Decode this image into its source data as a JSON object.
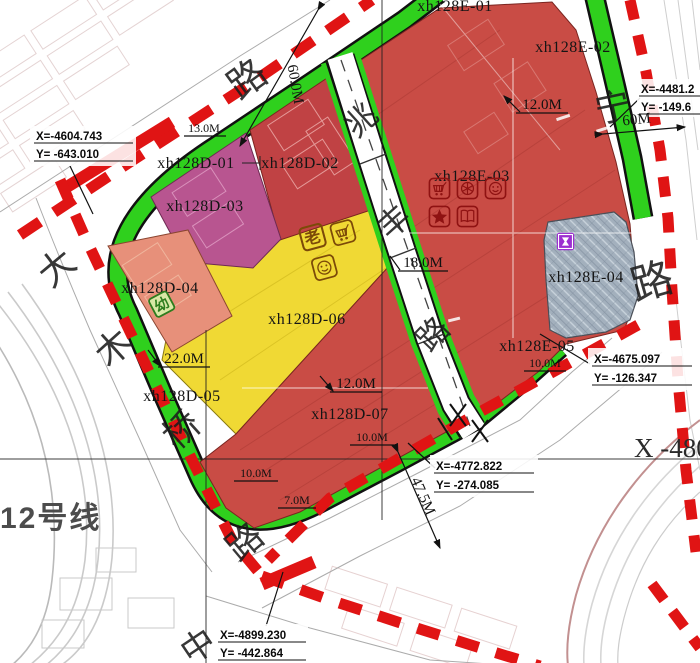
{
  "zones": {
    "d01": {
      "label": "xh128D-01"
    },
    "d02": {
      "label": "xh128D-02"
    },
    "d03": {
      "label": "xh128D-03"
    },
    "d04": {
      "label": "xh128D-04"
    },
    "d05": {
      "label": "xh128D-05"
    },
    "d06": {
      "label": "xh128D-06"
    },
    "d07": {
      "label": "xh128D-07"
    },
    "e01": {
      "label": "xh128E-01"
    },
    "e02": {
      "label": "xh128E-02"
    },
    "e03": {
      "label": "xh128E-03"
    },
    "e04": {
      "label": "xh128E-04"
    },
    "e05": {
      "label": "xh128E-05"
    }
  },
  "roads": {
    "top": {
      "name_char": "路",
      "width_label": "60.0M"
    },
    "left": {
      "chars": [
        "大",
        "木",
        "桥",
        "路"
      ]
    },
    "middle": {
      "chars": [
        "兆",
        "丰",
        "路"
      ]
    },
    "right": {
      "chars": [
        "宁",
        "路"
      ],
      "width_label": "60M"
    },
    "bottom": {
      "char": "中"
    }
  },
  "coordinates": [
    {
      "x": "X=-4604.743",
      "y": "Y= -643.010"
    },
    {
      "x": "X=-4481.2",
      "y": "Y= -149.6"
    },
    {
      "x": "X=-4675.097",
      "y": "Y= -126.347"
    },
    {
      "x": "X=-4772.822",
      "y": "Y= -274.085"
    },
    {
      "x": "X=-4899.230",
      "y": "Y= -442.864"
    }
  ],
  "dimensions": {
    "d13": "13.0M",
    "d12_top": "12.0M",
    "d18": "18.0M",
    "d22": "22.0M",
    "d12_mid": "12.0M",
    "d10_a": "10.0M",
    "d10_b": "10.0M",
    "d10_c": "10.0M",
    "d7": "7.0M",
    "d47": "47.5M"
  },
  "annotations": {
    "metro_line": "12号线",
    "grid_label": "X -480"
  },
  "icons": {
    "elderly": "老",
    "kindergarten": "幼"
  },
  "colors": {
    "belt_green": "#2fd01d",
    "zone_red": "#c94c45",
    "zone_red_dark": "#c04244",
    "zone_magenta": "#b85590",
    "zone_salmon": "#e7907a",
    "zone_yellow": "#f0d934",
    "hatch_gray": "#a3b0bd",
    "icon_purple": "#9b2fd0",
    "dash_red": "#e01414"
  }
}
